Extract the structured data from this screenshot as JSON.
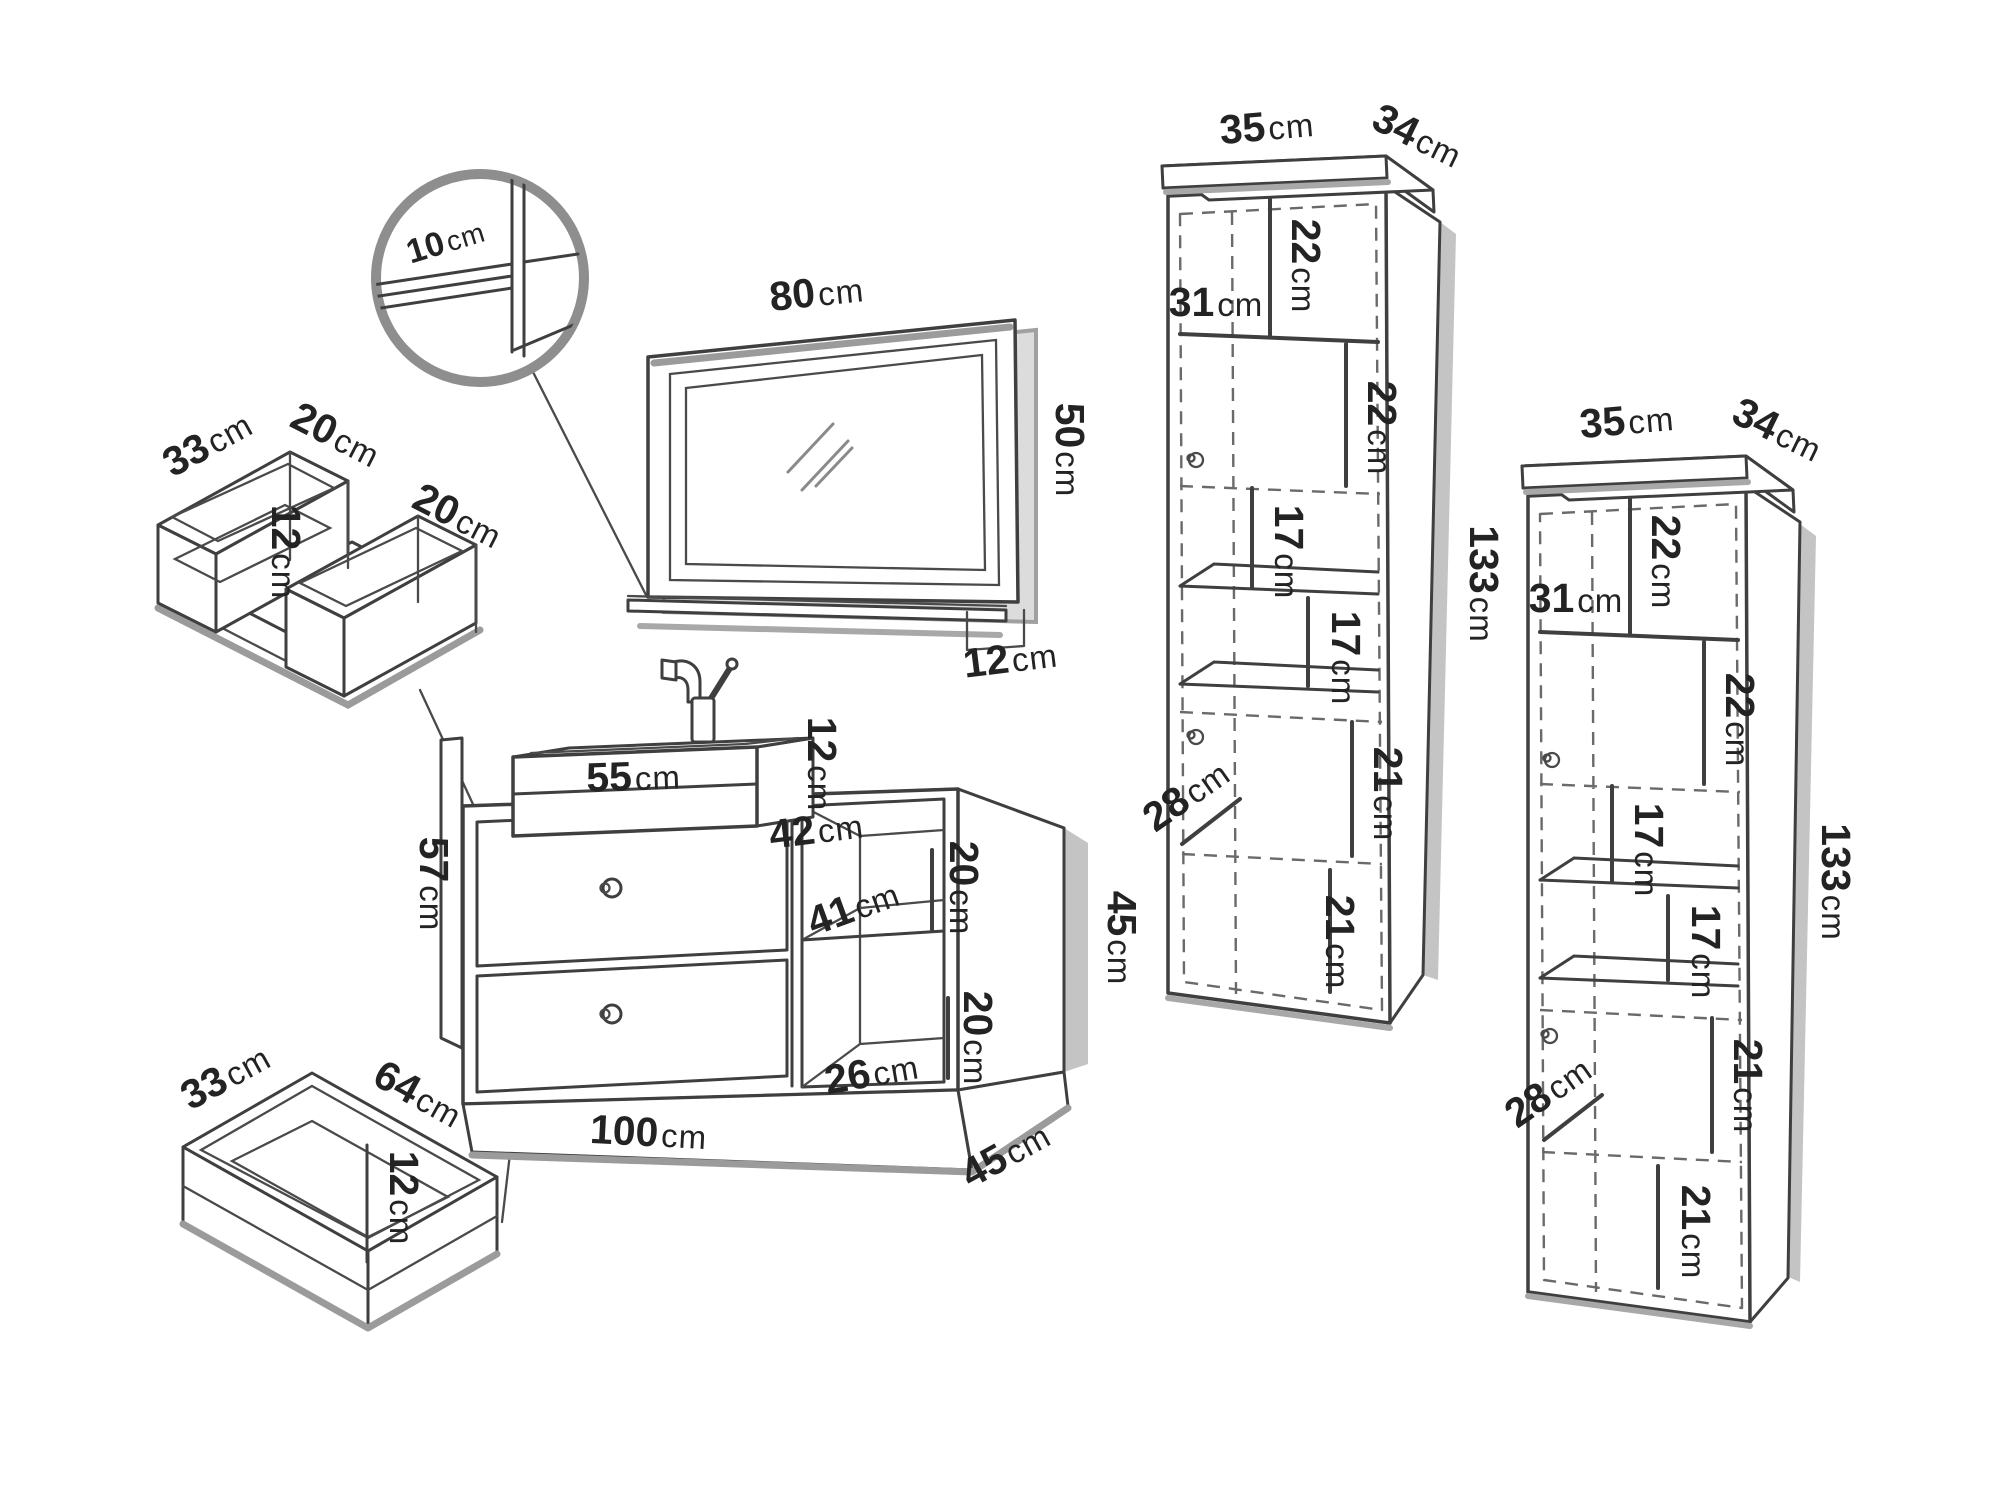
{
  "unit": "cm",
  "colors": {
    "line": "#3f3f3f",
    "shadow": "#9b9b9b",
    "label": "#232323",
    "background": "#ffffff"
  },
  "detail_view": {
    "shelf_thickness": "10"
  },
  "mirror": {
    "width": "80",
    "height": "50",
    "shelf_depth": "12"
  },
  "top_drawer": {
    "depth": "33",
    "left_width": "20",
    "right_width": "20",
    "height": "12"
  },
  "bottom_drawer": {
    "depth": "33",
    "width": "64",
    "height": "12"
  },
  "sink": {
    "width": "55",
    "height": "12"
  },
  "vanity": {
    "panel_height": "57",
    "top_depth": "42",
    "shelf_width": "41",
    "upper_shelf_height": "20",
    "lower_shelf_height": "20",
    "bottom_width": "26",
    "width": "100",
    "side_height": "45",
    "depth": "45"
  },
  "left_cabinet": {
    "width": "35",
    "depth": "34",
    "top_section_height": "22",
    "door_width": "31",
    "second_section_height": "22",
    "shelf_gap_1": "17",
    "shelf_gap_2": "17",
    "door_section_height": "21",
    "door_depth": "28",
    "bottom_section_height": "21",
    "height": "133"
  },
  "right_cabinet": {
    "width": "35",
    "depth": "34",
    "top_section_height": "22",
    "door_width": "31",
    "second_section_height": "22",
    "shelf_gap_1": "17",
    "shelf_gap_2": "17",
    "door_section_height": "21",
    "door_depth": "28",
    "bottom_section_height": "21",
    "height": "133"
  }
}
